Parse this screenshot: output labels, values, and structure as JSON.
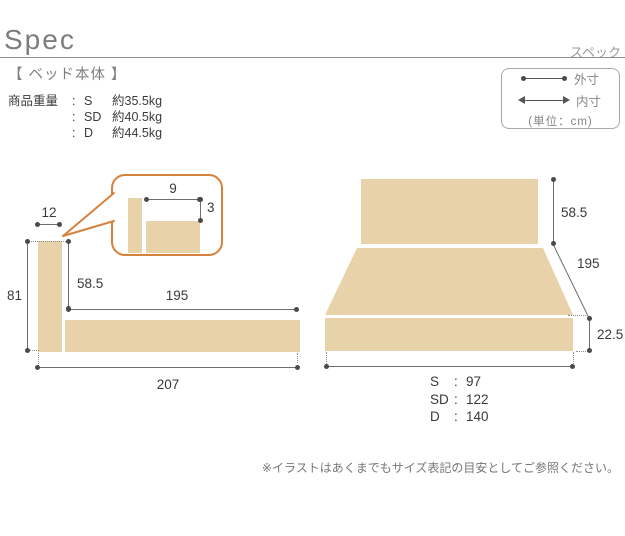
{
  "header": {
    "title": "Spec",
    "title_jp": "スペック"
  },
  "section": {
    "label": "【 ベッド本体 】"
  },
  "weights": {
    "label": "商品重量",
    "colon": ":",
    "rows": [
      {
        "size": "S",
        "value": "約35.5kg"
      },
      {
        "size": "SD",
        "value": "約40.5kg"
      },
      {
        "size": "D",
        "value": "約44.5kg"
      }
    ]
  },
  "legend": {
    "outer_label": "外寸",
    "inner_label": "内寸",
    "unit_label": "(単位：cm)"
  },
  "side_view": {
    "headboard_thickness": "12",
    "total_height": "81",
    "headboard_height": "58.5",
    "inner_length": "195",
    "total_length": "207",
    "detail": {
      "gap_width": "9",
      "step_height": "3"
    }
  },
  "front_view": {
    "headboard_height": "58.5",
    "inner_length": "195",
    "base_height": "22.5",
    "colon": ":",
    "widths": [
      {
        "size": "S",
        "value": "97"
      },
      {
        "size": "SD",
        "value": "122"
      },
      {
        "size": "D",
        "value": "140"
      }
    ]
  },
  "footnote": "※イラストはあくまでもサイズ表記の目安としてご参照ください。",
  "colors": {
    "wood": "#e8d2a9",
    "accent_orange": "#d6813c",
    "dim_line": "#6e6e6e",
    "dot": "#4a4a4a",
    "text_dark": "#3a3a3a",
    "text_gray": "#858585"
  }
}
